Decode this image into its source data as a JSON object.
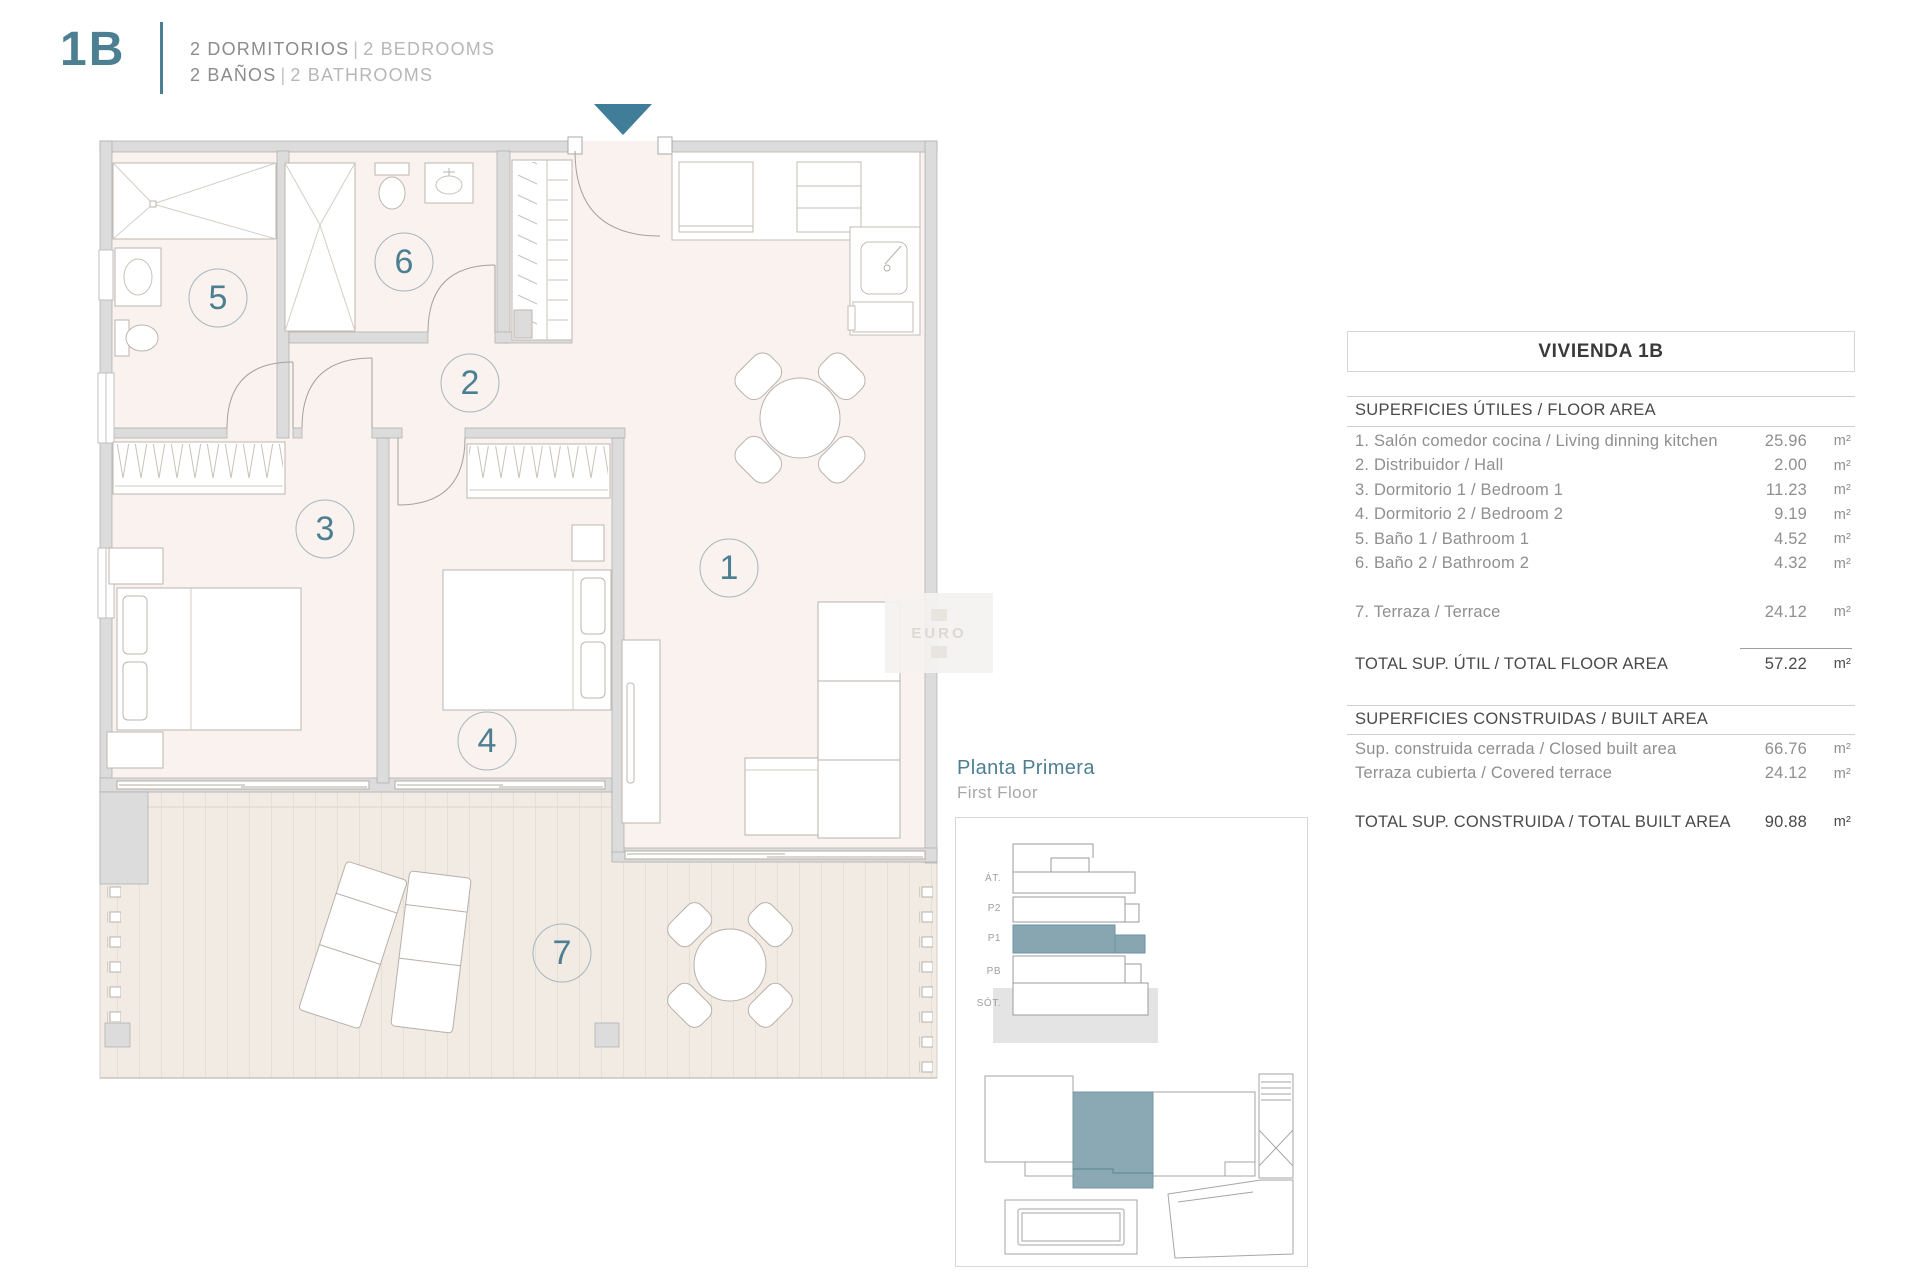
{
  "header": {
    "unit": "1B",
    "line1": {
      "es": "2 DORMITORIOS",
      "sep": "|",
      "en": "2 BEDROOMS"
    },
    "line2": {
      "es": "2 BAÑOS",
      "sep": "|",
      "en": "2 BATHROOMS"
    }
  },
  "plan": {
    "rooms": [
      "1",
      "2",
      "3",
      "4",
      "5",
      "6",
      "7"
    ],
    "watermark": "EURO"
  },
  "panel": {
    "title": "VIVIENDA 1B",
    "floor_area": {
      "heading": "SUPERFICIES ÚTILES / FLOOR AREA",
      "rows": [
        {
          "label": "1. Salón comedor cocina / Living dinning kitchen",
          "value": "25.96",
          "unit": "m²"
        },
        {
          "label": "2. Distribuidor / Hall",
          "value": "2.00",
          "unit": "m²"
        },
        {
          "label": "3. Dormitorio 1 / Bedroom 1",
          "value": "11.23",
          "unit": "m²"
        },
        {
          "label": "4. Dormitorio 2 / Bedroom 2",
          "value": "9.19",
          "unit": "m²"
        },
        {
          "label": "5. Baño 1 / Bathroom 1",
          "value": "4.52",
          "unit": "m²"
        },
        {
          "label": "6. Baño 2 / Bathroom 2",
          "value": "4.32",
          "unit": "m²"
        }
      ],
      "terrace": {
        "label": "7. Terraza / Terrace",
        "value": "24.12",
        "unit": "m²"
      },
      "total": {
        "label": "TOTAL SUP. ÚTIL / TOTAL FLOOR AREA",
        "value": "57.22",
        "unit": "m²"
      }
    },
    "built_area": {
      "heading": "SUPERFICIES CONSTRUIDAS / BUILT AREA",
      "rows": [
        {
          "label": "Sup. construida cerrada / Closed built area",
          "value": "66.76",
          "unit": "m²"
        },
        {
          "label": "Terraza cubierta / Covered terrace",
          "value": "24.12",
          "unit": "m²"
        }
      ],
      "total": {
        "label": "TOTAL SUP. CONSTRUIDA /  TOTAL BUILT AREA",
        "value": "90.88",
        "unit": "m²"
      }
    }
  },
  "location": {
    "title_es": "Planta Primera",
    "title_en": "First Floor",
    "floor_labels": [
      "ÁT.",
      "P2",
      "P1",
      "PB",
      "SÓT."
    ]
  },
  "colors": {
    "accent": "#4d7f93",
    "arrow": "#3f7d98",
    "highlight": "#8aa9b4"
  }
}
